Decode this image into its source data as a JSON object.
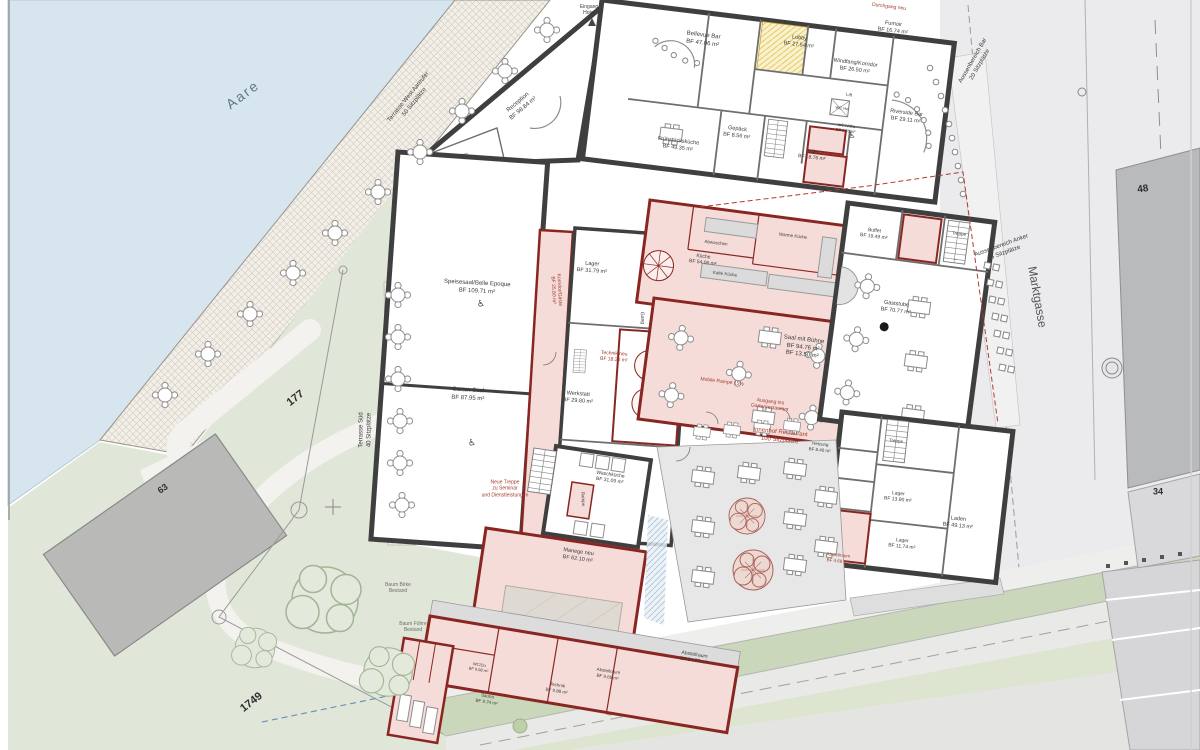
{
  "site": {
    "river": "Aare",
    "street": "Marktgasse",
    "parcel_garden": "177",
    "parcel_meadow": "1749",
    "building_west": "63",
    "building_north": "48",
    "building_south": "34",
    "terrace_west": "Terrasse West Aareufer\n50 Sitzplätze",
    "terrace_sued": "Terrasse Süd\n40 Sitzplätze",
    "aussenbereich_bar": "Aussenbereich Bar\n20 Sitzplätze",
    "aussenbereich_anker": "Aussenbereich Anker\n16 Sitzplätze",
    "innenhof": "Innenhof Restaurant\n100 Sitzplätze",
    "eingang_hotel": "Eingang\nHotel",
    "durchgang_neu": "Durchgang neu",
    "gang": "Gang",
    "rampe": "Rampe",
    "mobile_rampe": "Mobile Rampe 15%",
    "ausgang_garten": "Ausgang ins\nGartenrestaurant",
    "neue_treppe": "Neue Treppe\nzu Seminar\nund Dienstleistungen",
    "baum_birke": "Baum Birke\nBestand",
    "baum_foehre": "Baum Föhre\nBestand"
  },
  "rooms": {
    "reception": {
      "label": "Reception",
      "area": "BF 98.84 m²"
    },
    "buero": {
      "label": "Büro"
    },
    "bellevue_bar": {
      "label": "Bellevue Bar",
      "area": "BF 47.06 m²"
    },
    "lobby": {
      "label": "Lobby",
      "area": "BF 27.54 m²"
    },
    "fumoir": {
      "label": "Fumoir",
      "area": "BF 16.74 m²"
    },
    "windfang": {
      "label": "Windfang/Korridor",
      "area": "BF 26.50 m²"
    },
    "fruehstueckskueche": {
      "label": "Frühstücksküche",
      "area": "BF 49.35 m²"
    },
    "gepaeck": {
      "label": "Gepäck",
      "area": "BF 8.56 m²"
    },
    "lift": {
      "label": "Lift"
    },
    "keller": {
      "label": "Keller",
      "area": "BF 18.76 m²"
    },
    "wc_herren": {
      "label": "WC He"
    },
    "wc_iv": {
      "label": "WC IV/Da",
      "area": "BF 8.26 m²"
    },
    "riverside_bar": {
      "label": "Riverside Bar",
      "area": "BF 29.11 m²"
    },
    "speisesaal": {
      "label": "Speisesaal/Belle Epoque",
      "area": "BF 109.71 m²"
    },
    "gartensaal": {
      "label": "Garten Saal",
      "area": "BF 87.95 m²"
    },
    "korridor_gaeste": {
      "label": "Korridor/Gäste",
      "area": "BF 25.80 m²"
    },
    "lager_west": {
      "label": "Lager",
      "area": "BF 31.79 m²"
    },
    "technik_neu": {
      "label": "Technik neu",
      "area": "BF 18.28 m²"
    },
    "werkstatt": {
      "label": "Werkstatt",
      "area": "BF 29.80 m²"
    },
    "abwaschen": {
      "label": "Abwaschen"
    },
    "kueche": {
      "label": "Küche",
      "area": "BF 54.06 m²"
    },
    "kalte_kueche": {
      "label": "Kalte Küche"
    },
    "warme_kueche": {
      "label": "Warme Küche"
    },
    "saal_buehne": {
      "label": "Saal mit Bühne",
      "area": "BF 94.76 m²\nBF 13.50 m²"
    },
    "buffet": {
      "label": "Buffet",
      "area": "BF 19.49 m²"
    },
    "gaststube": {
      "label": "Gaststube",
      "area": "BF 70.77 m²"
    },
    "treppe": {
      "label": "Treppe"
    },
    "heizung": {
      "label": "Heizung",
      "area": "BF 8.40 m²"
    },
    "abstellraum_alt": {
      "label": "Abstellraum",
      "area": "BF 4.69 m²"
    },
    "lager_se1": {
      "label": "Lager",
      "area": "BF 13.90 m²"
    },
    "lager_se2": {
      "label": "Lager",
      "area": "BF 11.74 m²"
    },
    "laden": {
      "label": "Laden",
      "area": "BF 49.13 m²"
    },
    "waschkueche": {
      "label": "Waschküche",
      "area": "BF 31.09 m²"
    },
    "manege": {
      "label": "Manege neu",
      "area": "BF 62.10 m²"
    },
    "wc_du": {
      "label": "WC/Du",
      "area": "BF 6.08 m²"
    },
    "sauna": {
      "label": "Sauna",
      "area": "BF 9.74 m²"
    },
    "technik_anbau": {
      "label": "Technik",
      "area": "BF 9.88 m²"
    },
    "abstellraum1": {
      "label": "Abstellraum",
      "area": "BF 9.69 m²"
    },
    "abstellraum2": {
      "label": "Abstellraum",
      "area": "BF 24.79 m²"
    }
  }
}
